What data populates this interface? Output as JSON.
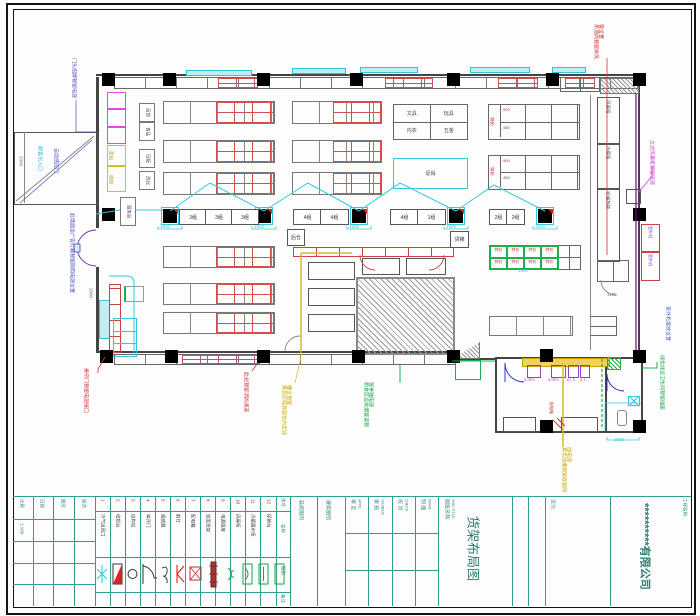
{
  "annotations": {
    "entry_sign": "门头招牌预留电源",
    "entrance": "顾客出入口",
    "auto_door": "自动感应门",
    "wall_ad": "此墙面设广告灯箱预留照明电源位置",
    "roller_door": "卷帘门预留电源接口",
    "fire_exit": "此处预留消防通道",
    "yellow_left": "黄色区域收银台内走线槽位预留",
    "green_center": "熟食区设排烟管道预留单独电源",
    "yellow_right": "黄色线槽预留收银网线电源",
    "green_right": "绿色线设卫生间预留插座",
    "air_curtain": "立式风幕柜预留电源",
    "vent_right": "吊顶内预留排风管位置",
    "outdoor_pos": "室外机摆放位置",
    "power_box": "配电箱"
  },
  "dims": {
    "d1500": "1500",
    "d1950": "1950",
    "d1100": "1100",
    "d2000": "2000",
    "d3300": "3300"
  },
  "plan": {
    "promo_label": "促销",
    "dept_cells": [
      "文具",
      "玩具",
      "内衣",
      "五金"
    ],
    "grid_side_label": "特价",
    "grid_cell_top": "900",
    "grid_cell_bottom": "450",
    "green_cell": "特价",
    "aisle_boxes": [
      "百货",
      "食品",
      "日配",
      "洗化"
    ],
    "service_box": "服务台",
    "cabinet_label": "冷柜",
    "bakery_labels": [
      "面包",
      "烘焙"
    ],
    "checkout_groups_a": [
      "3组",
      "3组",
      "3组"
    ],
    "checkout_groups_b": [
      "4组",
      "4组"
    ],
    "checkout_groups_c": [
      "4组",
      "1组"
    ],
    "checkout_groups_d": [
      "2组",
      "2组"
    ],
    "small_box_left": "后仓",
    "small_box_right": "货梯",
    "corridor_shelves": [
      "风幕柜",
      "冷藏柜",
      "仓储货架"
    ],
    "outdoor_unit": "室外机",
    "room_codes": [
      "3-6P4",
      "5-6P4",
      "1C-3",
      "4-1"
    ]
  },
  "titleblock": {
    "info": {
      "labels": [
        "比例",
        "日期",
        "图号",
        "版次"
      ],
      "scale": "1:100"
    },
    "legend": {
      "col_headers": {
        "no": "序号",
        "name": "名称",
        "symbol": "图例",
        "note": "备注"
      },
      "items": [
        {
          "no": "1",
          "name": "冷气出风口",
          "icon": "snowflake-icon"
        },
        {
          "no": "2",
          "name": "收银台",
          "icon": "cashier-icon"
        },
        {
          "no": "3",
          "name": "结构柱",
          "icon": "circle-icon"
        },
        {
          "no": "4",
          "name": "单开门",
          "icon": "door-icon"
        },
        {
          "no": "5",
          "name": "烟感器",
          "icon": "smoke-icon"
        },
        {
          "no": "6",
          "name": "射灯",
          "icon": "spotlight-icon"
        },
        {
          "no": "7",
          "name": "配电箱",
          "icon": "power-box-icon"
        },
        {
          "no": "8",
          "name": "双面货架",
          "icon": "shelf-icon"
        },
        {
          "no": "9",
          "name": "电源插座",
          "icon": "socket-icon"
        },
        {
          "no": "10",
          "name": "风幕柜",
          "icon": "air-curtain-icon"
        },
        {
          "no": "11",
          "name": "冷藏展示柜",
          "icon": "cooler-icon"
        },
        {
          "no": "12",
          "name": "促销台",
          "icon": "promo-icon"
        }
      ]
    },
    "legend_groups": [
      "装修图例",
      "建筑图例"
    ],
    "signoff": [
      {
        "label": "审 定",
        "sub": "APPD"
      },
      {
        "label": "审 核",
        "sub": "1014B028"
      },
      {
        "label": "校 对",
        "sub": "CHECK"
      },
      {
        "label": "制 图",
        "sub": "DRAW"
      }
    ],
    "name_label": "图纸名称:",
    "job_title": "JOB TITLE",
    "drawing_title": "货架布局图",
    "design_label": "设计:",
    "project_label": "工程名称:",
    "company": "**********有限公司"
  }
}
